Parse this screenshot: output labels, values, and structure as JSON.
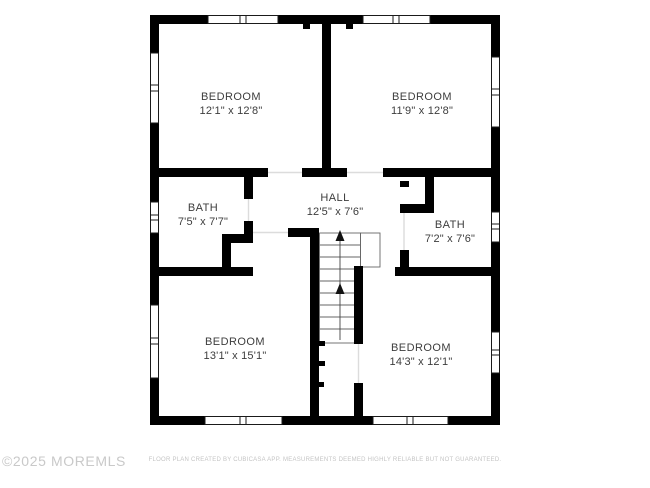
{
  "plan": {
    "rooms": [
      {
        "name": "BEDROOM",
        "dims": "12'1\" x 12'8\"",
        "position": "top-left"
      },
      {
        "name": "BEDROOM",
        "dims": "11'9\" x 12'8\"",
        "position": "top-right"
      },
      {
        "name": "BATH",
        "dims": "7'5\" x 7'7\"",
        "position": "middle-left"
      },
      {
        "name": "HALL",
        "dims": "12'5\" x 7'6\"",
        "position": "middle-center"
      },
      {
        "name": "BATH",
        "dims": "7'2\" x 7'6\"",
        "position": "middle-right"
      },
      {
        "name": "BEDROOM",
        "dims": "13'1\" x 15'1\"",
        "position": "bottom-left"
      },
      {
        "name": "BEDROOM",
        "dims": "14'3\" x 12'1\"",
        "position": "bottom-right"
      }
    ],
    "stairs_direction": "up",
    "watermark": "©2025 MOREMLS",
    "disclaimer": "FLOOR PLAN CREATED BY CUBICASA APP. MEASUREMENTS DEEMED HIGHLY RELIABLE BUT NOT GUARANTEED."
  },
  "colors": {
    "background": "#ffffff",
    "wall": "#000000",
    "room_text": "#3d3d3d",
    "stair_line": "#555555",
    "door_gap_line": "#dcdcdc",
    "watermark_text": "#c9c9c9",
    "disclaimer_text": "#c4c4c4"
  }
}
